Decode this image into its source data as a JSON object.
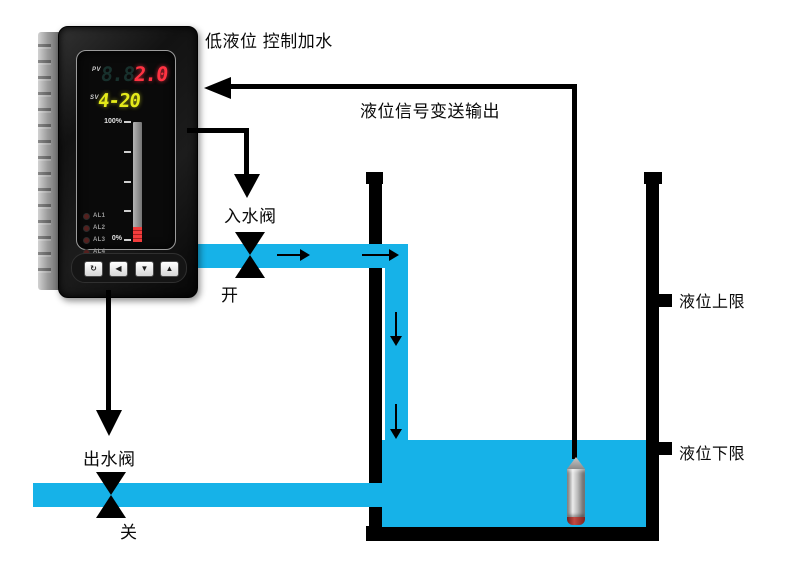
{
  "title": "低液位 控制加水",
  "signal": {
    "label": "液位信号变送输出"
  },
  "controller": {
    "pv_label": "PV",
    "pv_ghost": "8.8",
    "pv_value": "2.0",
    "sv_label": "SV",
    "sv_value": "4-20",
    "bar_top": "100%",
    "bar_bottom": "0%",
    "leds": [
      "AL1",
      "AL2",
      "AL3",
      "AL4"
    ],
    "buttons": [
      "↻",
      "◀",
      "▼",
      "▲"
    ]
  },
  "inlet_valve": {
    "label": "入水阀",
    "state": "开"
  },
  "outlet_valve": {
    "label": "出水阀",
    "state": "关"
  },
  "tank": {
    "upper_limit": "液位上限",
    "lower_limit": "液位下限"
  },
  "colors": {
    "water": "#16b2e8",
    "line": "#000000",
    "pv": "#ff3342",
    "sv": "#e4ea1a"
  }
}
